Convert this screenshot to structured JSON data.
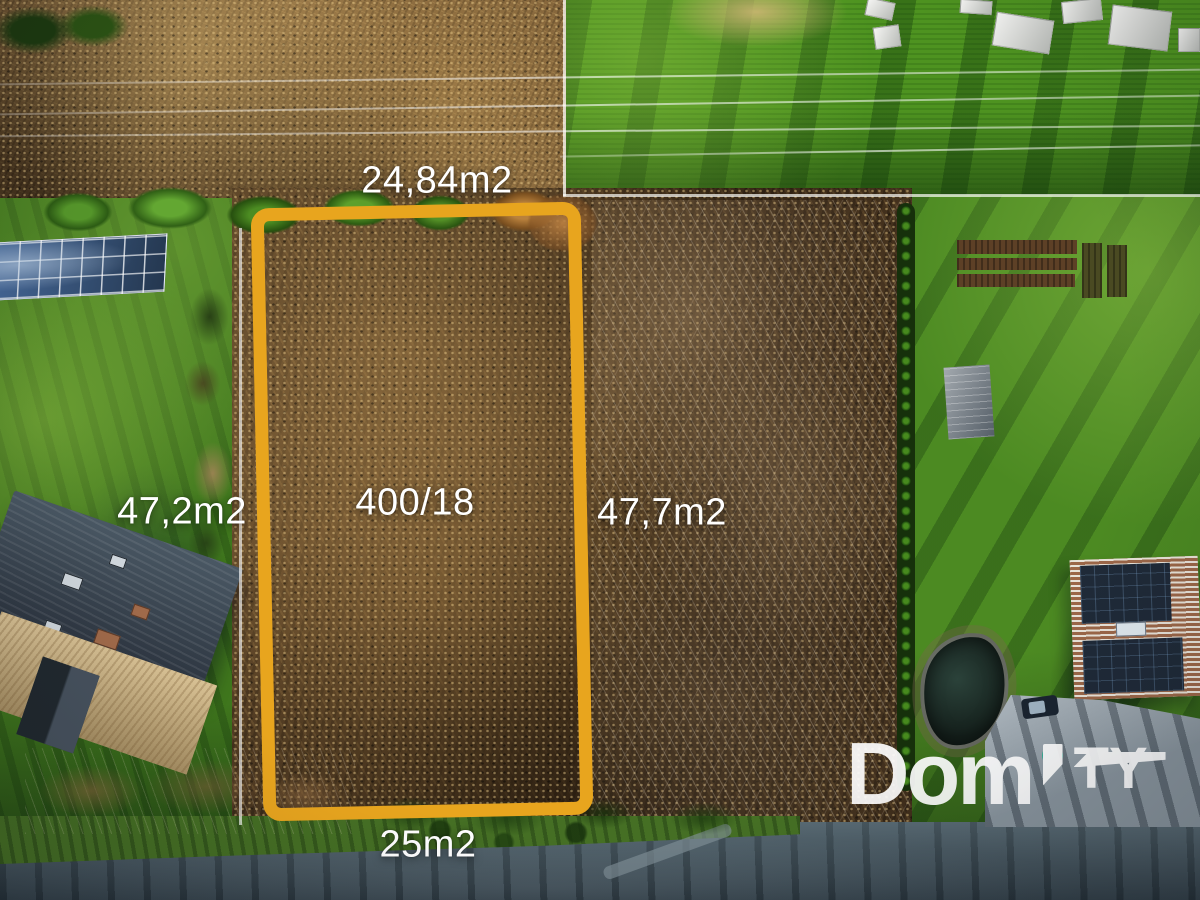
{
  "annotations": {
    "side_top": {
      "text": "24,84m2"
    },
    "side_left": {
      "text": "47,2m2"
    },
    "side_right": {
      "text": "47,7m2"
    },
    "side_bottom": {
      "text": "25m2"
    },
    "parcel_number": {
      "text": "400/18"
    }
  },
  "plot": {
    "outline_color": "#E8A51E"
  },
  "watermark": {
    "word_primary": "Dom",
    "word_secondary": "TY",
    "dot_color": "#2BAD90",
    "text_color": "#FFFFFF"
  },
  "scene_colors": {
    "scrub_brown": "#4A3620",
    "reed_field_tan": "#7A5C36",
    "meadow_green": "#4E9320",
    "lawn_green": "#3F761D",
    "garden_green": "#4C8A22",
    "road_gray": "#46565F"
  }
}
